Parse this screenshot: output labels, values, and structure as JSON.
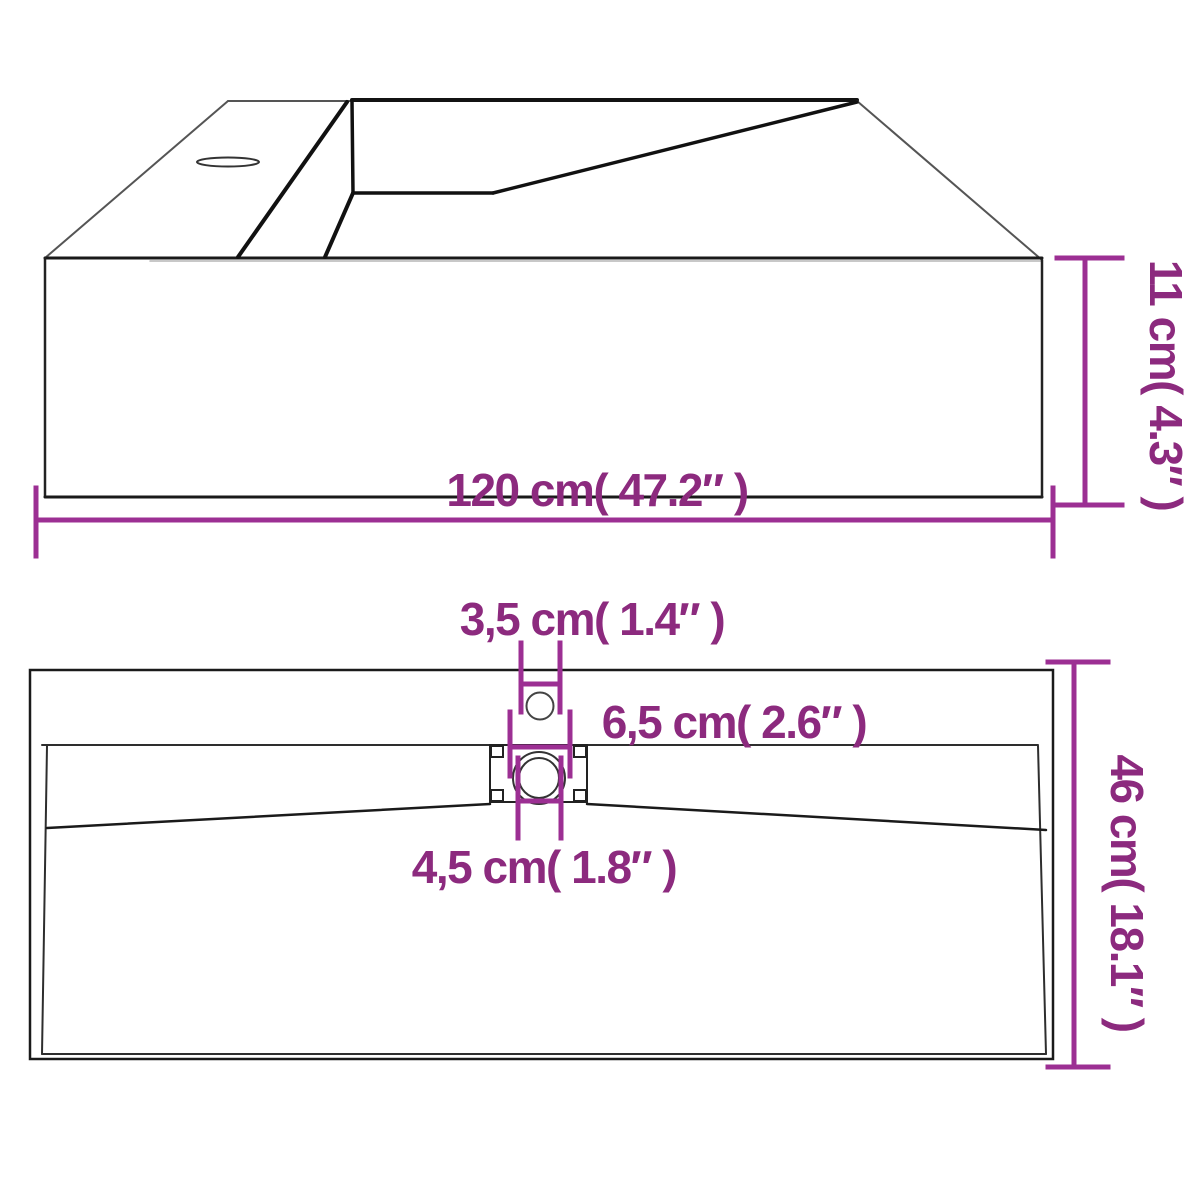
{
  "colors": {
    "dimension_line": "#9c2f93",
    "label_text": "#8c2a7e",
    "outline_dark": "#1a1a1a",
    "outline_gray": "#555555",
    "background": "#ffffff"
  },
  "perspective_view": {
    "width_label": "120 cm( 47.2″ )",
    "height_label": "11 cm( 4.3″ )"
  },
  "top_view": {
    "faucet_hole_label": "3,5 cm( 1.4″ )",
    "drain_flange_label": "6,5 cm( 2.6″ )",
    "drain_hole_label": "4,5 cm( 1.8″ )",
    "depth_label": "46 cm( 18.1″ )"
  }
}
